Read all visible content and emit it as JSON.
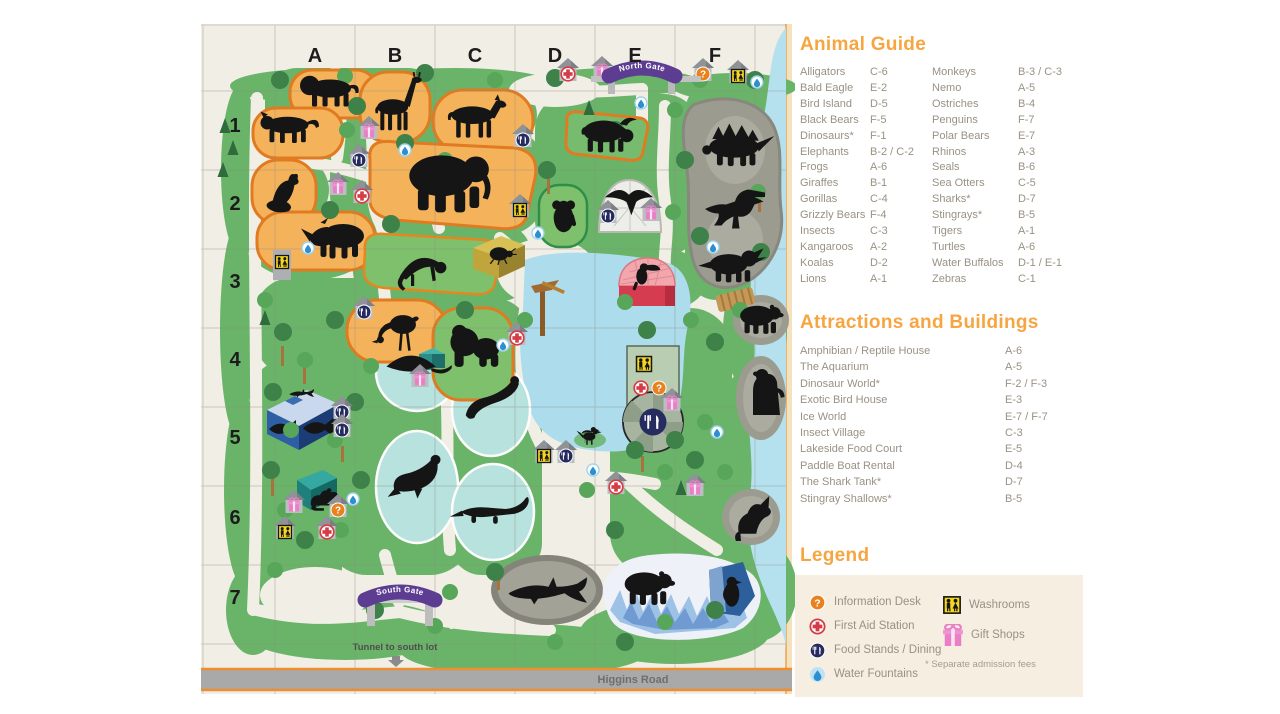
{
  "map": {
    "columns": [
      "A",
      "B",
      "C",
      "D",
      "E",
      "F"
    ],
    "rows": [
      "1",
      "2",
      "3",
      "4",
      "5",
      "6",
      "7"
    ],
    "north_gate_label": "North Gate",
    "south_gate_label": "South Gate",
    "tunnel_label": "Tunnel to south lot",
    "road_label": "Higgins Road"
  },
  "animal_guide": {
    "title": "Animal Guide",
    "entries": [
      {
        "name": "Alligators",
        "loc": "C-6"
      },
      {
        "name": "Bald Eagle",
        "loc": "E-2"
      },
      {
        "name": "Bird Island",
        "loc": "D-5"
      },
      {
        "name": "Black Bears",
        "loc": "F-5"
      },
      {
        "name": "Dinosaurs*",
        "loc": "F-1"
      },
      {
        "name": "Elephants",
        "loc": "B-2 / C-2"
      },
      {
        "name": "Frogs",
        "loc": "A-6"
      },
      {
        "name": "Giraffes",
        "loc": "B-1"
      },
      {
        "name": "Gorillas",
        "loc": "C-4"
      },
      {
        "name": "Grizzly Bears",
        "loc": "F-4"
      },
      {
        "name": "Insects",
        "loc": "C-3"
      },
      {
        "name": "Kangaroos",
        "loc": "A-2"
      },
      {
        "name": "Koalas",
        "loc": "D-2"
      },
      {
        "name": "Lions",
        "loc": "A-1"
      },
      {
        "name": "Monkeys",
        "loc": "B-3 / C-3"
      },
      {
        "name": "Nemo",
        "loc": "A-5"
      },
      {
        "name": "Ostriches",
        "loc": "B-4"
      },
      {
        "name": "Penguins",
        "loc": "F-7"
      },
      {
        "name": "Polar Bears",
        "loc": "E-7"
      },
      {
        "name": "Rhinos",
        "loc": "A-3"
      },
      {
        "name": "Seals",
        "loc": "B-6"
      },
      {
        "name": "Sea Otters",
        "loc": "C-5"
      },
      {
        "name": "Sharks*",
        "loc": "D-7"
      },
      {
        "name": "Stingrays*",
        "loc": "B-5"
      },
      {
        "name": "Tigers",
        "loc": "A-1"
      },
      {
        "name": "Turtles",
        "loc": "A-6"
      },
      {
        "name": "Water Buffalos",
        "loc": "D-1 / E-1"
      },
      {
        "name": "Zebras",
        "loc": "C-1"
      }
    ]
  },
  "attractions": {
    "title": "Attractions and Buildings",
    "entries": [
      {
        "name": "Amphibian / Reptile House",
        "loc": "A-6"
      },
      {
        "name": "The Aquarium",
        "loc": "A-5"
      },
      {
        "name": "Dinosaur World*",
        "loc": "F-2 / F-3"
      },
      {
        "name": "Exotic Bird House",
        "loc": "E-3"
      },
      {
        "name": "Ice World",
        "loc": "E-7 / F-7"
      },
      {
        "name": "Insect Village",
        "loc": "C-3"
      },
      {
        "name": "Lakeside Food Court",
        "loc": "E-5"
      },
      {
        "name": "Paddle Boat Rental",
        "loc": "D-4"
      },
      {
        "name": "The Shark Tank*",
        "loc": "D-7"
      },
      {
        "name": "Stingray Shallows*",
        "loc": "B-5"
      }
    ]
  },
  "legend": {
    "title": "Legend",
    "items_left": [
      {
        "label": "Information Desk",
        "icon": "information-desk-icon"
      },
      {
        "label": "First Aid Station",
        "icon": "first-aid-icon"
      },
      {
        "label": "Food Stands / Dining",
        "icon": "food-stands-icon"
      },
      {
        "label": "Water Fountains",
        "icon": "water-fountain-icon"
      }
    ],
    "items_right": [
      {
        "label": "Washrooms",
        "icon": "washrooms-icon"
      },
      {
        "label": "Gift Shops",
        "icon": "gift-shops-icon"
      }
    ],
    "footnote": "* Separate admission fees"
  },
  "colors": {
    "heading_orange": "#F7A541",
    "body_text": "#9A9183",
    "legend_bg": "#F6EEE1",
    "map_bg": "#F1EEE6",
    "park_green": "#69B468",
    "pen_orange_fill": "#F4B35B",
    "pen_orange_border": "#E07B22",
    "lake_blue": "#ADDCEC",
    "pool_teal": "#B7E2DD",
    "gate_purple": "#5C3D92",
    "info_orange": "#E8821E",
    "aid_red": "#D43C46",
    "food_navy": "#272C60",
    "wash_yellow": "#F3D623",
    "gift_pink": "#E97FC6"
  }
}
